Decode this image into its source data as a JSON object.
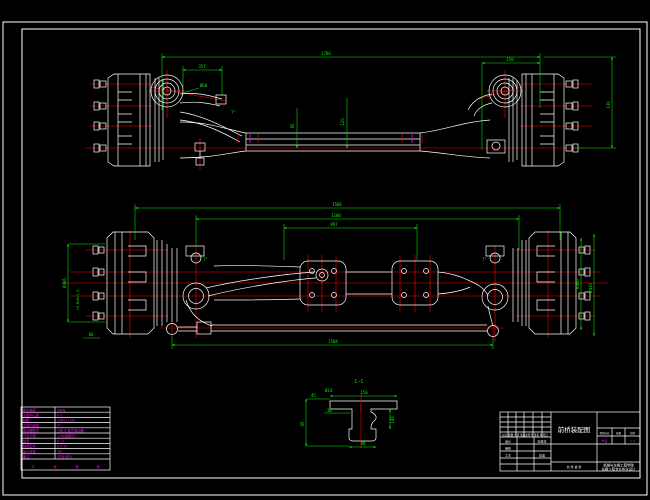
{
  "colors": {
    "background": "#000000",
    "geometry": "#ffffff",
    "dimensions": "#00f000",
    "centerlines": "#ff0000",
    "annotations": "#ff00ff"
  },
  "dims": {
    "tv_overall": "1786",
    "tv_left": "357",
    "tv_right": "150",
    "tv_height": "130",
    "tv_drop1": "85",
    "tv_drop2": "120",
    "tv_angle": "7°",
    "tv_kingpin": "Ø60",
    "fv_track": "1586",
    "fv_spring": "1100",
    "fv_inner": "897",
    "fv_tierod": "1504",
    "fv_drum_l": "Ø406",
    "fv_studs": "10-M20×1.5",
    "fv_drum_r": "Ø400",
    "fv_rim": "Ø410",
    "fv_hub": "86",
    "fv_angle_l": "7°",
    "fv_angle_r": "7°"
  },
  "section": {
    "label": "C-C",
    "top": "150",
    "hole": "Ø14",
    "pad": "45",
    "web": "30",
    "height": "140",
    "bottom": "80",
    "side": "95"
  },
  "spec_table": {
    "rows": [
      {
        "label": "额定轴荷",
        "value": "30kN"
      },
      {
        "label": "主销中心距",
        "value": "G-1"
      },
      {
        "label": "轮距",
        "value": "1586 (+20)"
      },
      {
        "label": "主销内倾角",
        "value": "7°"
      },
      {
        "label": "制动器型式",
        "value": "凸轮式 鼓式制动器"
      },
      {
        "label": "气室行程",
        "value": "≤35(调整后)"
      },
      {
        "label": "前束",
        "value": "0~2"
      },
      {
        "label": "轮辋型号",
        "value": "6.0-16"
      },
      {
        "label": "最大转角",
        "value": "35°"
      },
      {
        "label": "备注",
        "value": "(毕业设计)"
      }
    ],
    "footer": [
      "共",
      "张",
      "第",
      "张"
    ]
  },
  "title_block": {
    "title": "前桥装配图",
    "rev_header": "标记 处数 分区 更改文件号 签名 年月日",
    "row_design": "设计",
    "row_check": "审核",
    "row_process": "工艺",
    "row_standard": "标准化",
    "row_approve": "批准",
    "middle_footer": "共 张 第 张",
    "stage_header_1": "阶段标记",
    "stage_header_2": "质量",
    "stage_header_3": "比例",
    "stage_value_1": "毕设",
    "stage_value_3": "1:2",
    "org_line1": "机械与车辆工程学院",
    "org_line2": "车辆工程专业毕业设计"
  }
}
